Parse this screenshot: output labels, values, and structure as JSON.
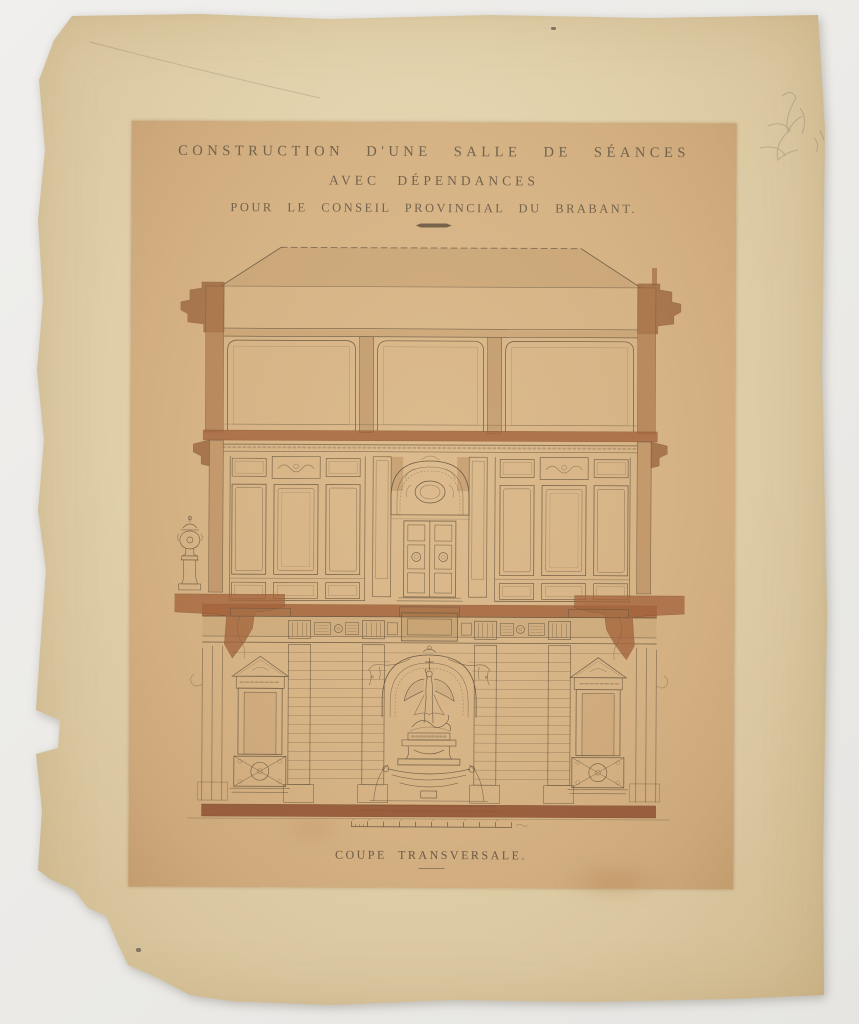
{
  "titles": {
    "line1": "CONSTRUCTION D'UNE SALLE DE SÉANCES",
    "line2": "AVEC DÉPENDANCES",
    "line3": "POUR LE CONSEIL PROVINCIAL DU BRABANT."
  },
  "caption": "COUPE TRANSVERSALE.",
  "colors": {
    "background": "#ebeae7",
    "paper": "#e0d0a8",
    "print_panel": "#d6b385",
    "ink": "#6d5b44",
    "wash_brown": "#a4643c",
    "base_band": "#8f5233"
  },
  "drawing": {
    "type": "architectural cross-section, ink and wash",
    "stories": [
      "hipped roof with dashed ridge line and eave cornices",
      "attic storey divided in three coved bays by two piers",
      "panelled meeting hall with central arched double door and ornamental urn on the left cornice",
      "rusticated ground floor with winged-figure statue in an arched niche above a fountain basin, flanked by pedimented doorways with lattice railings"
    ],
    "scale_bar": {
      "major_ticks": 10
    }
  }
}
